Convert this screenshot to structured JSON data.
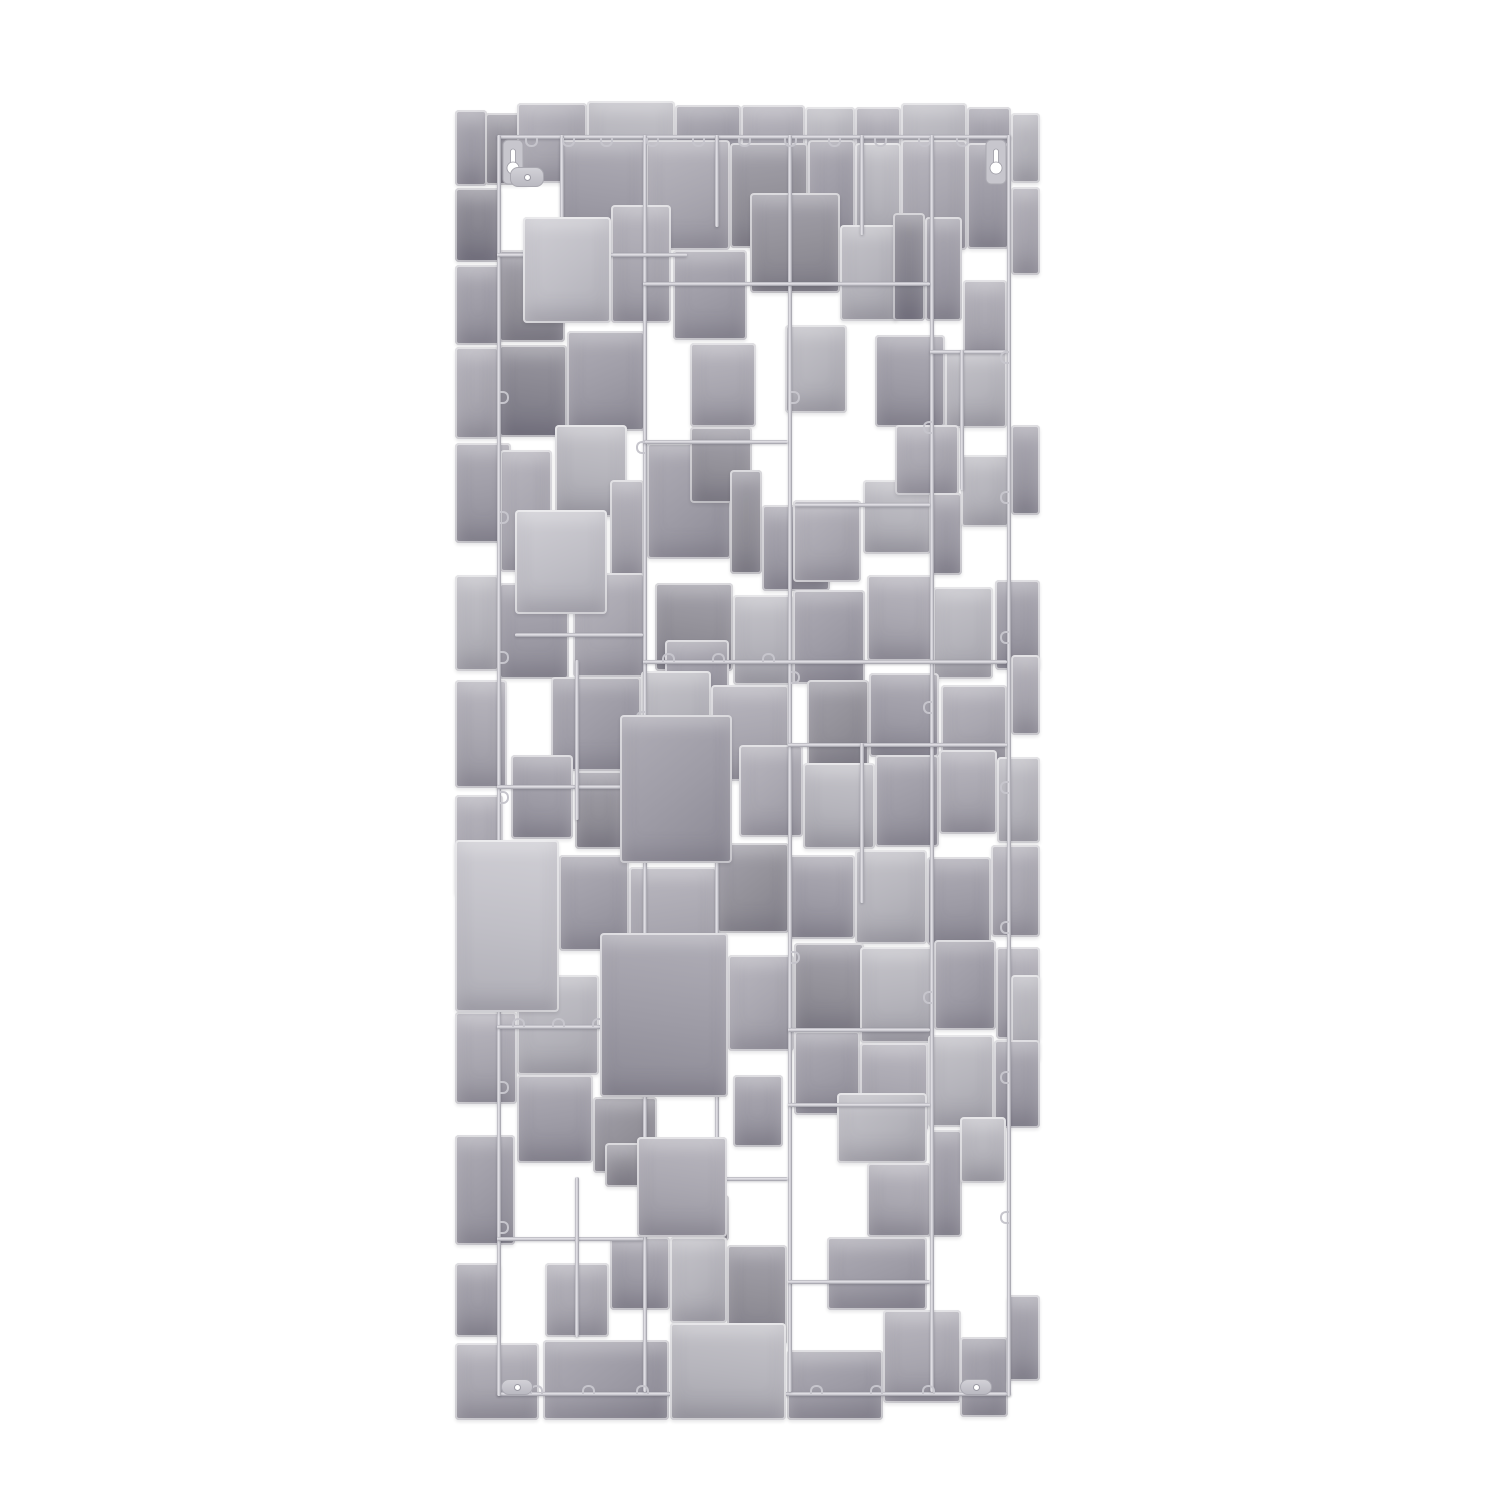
{
  "canvas": {
    "width": 1500,
    "height": 1500,
    "background": "#ffffff"
  },
  "artwork": {
    "name": "abstract-squares-metal-wall-sculpture",
    "x": 455,
    "y": 95,
    "width": 585,
    "height": 1325,
    "colors": {
      "wire_base": "#b4b3bb",
      "wire_light": "#e6e5ea",
      "wire_dark": "#9b9aa3",
      "clip": "#c6c5cc",
      "hanger_fill": "#c7c6cd",
      "hanger_stroke": "#a9a8b0",
      "hole": "#ffffff"
    },
    "palette": {
      "l1": [
        "#d0cfd5",
        "#c0bfc6",
        "#aeadb5"
      ],
      "l2": [
        "#c6c5cb",
        "#b6b5bc",
        "#a3a2aa"
      ],
      "m1": [
        "#bab8c0",
        "#a9a7b0",
        "#96949e"
      ],
      "m2": [
        "#b0aeb7",
        "#9e9ca6",
        "#8b8994"
      ],
      "d1": [
        "#a5a3ac",
        "#939199",
        "#817f89"
      ],
      "d2": [
        "#9a98a1",
        "#888690",
        "#767481"
      ]
    },
    "plates": [
      [
        0,
        15,
        32,
        76,
        "m2"
      ],
      [
        30,
        18,
        44,
        72,
        "d1"
      ],
      [
        62,
        8,
        70,
        80,
        "m1"
      ],
      [
        132,
        6,
        88,
        82,
        "l2"
      ],
      [
        220,
        10,
        66,
        72,
        "m2"
      ],
      [
        286,
        10,
        64,
        74,
        "m1"
      ],
      [
        350,
        12,
        50,
        70,
        "l2"
      ],
      [
        400,
        12,
        46,
        70,
        "m1"
      ],
      [
        446,
        8,
        66,
        78,
        "l2"
      ],
      [
        512,
        12,
        44,
        80,
        "m2"
      ],
      [
        556,
        18,
        29,
        70,
        "l2"
      ],
      [
        105,
        45,
        86,
        112,
        "m2"
      ],
      [
        191,
        45,
        84,
        110,
        "m1"
      ],
      [
        275,
        48,
        78,
        105,
        "d1"
      ],
      [
        353,
        45,
        47,
        102,
        "m2"
      ],
      [
        400,
        48,
        46,
        102,
        "l2"
      ],
      [
        446,
        45,
        66,
        110,
        "m1"
      ],
      [
        512,
        48,
        42,
        106,
        "m2"
      ],
      [
        556,
        92,
        29,
        88,
        "m1"
      ],
      [
        0,
        93,
        46,
        74,
        "d2"
      ],
      [
        0,
        170,
        46,
        80,
        "m2"
      ],
      [
        44,
        155,
        66,
        92,
        "d1"
      ],
      [
        68,
        122,
        88,
        106,
        "l1",
        1
      ],
      [
        156,
        110,
        60,
        118,
        "m1"
      ],
      [
        218,
        155,
        74,
        90,
        "m2"
      ],
      [
        295,
        98,
        90,
        100,
        "d1"
      ],
      [
        385,
        130,
        58,
        96,
        "l2"
      ],
      [
        438,
        118,
        32,
        108,
        "d2"
      ],
      [
        470,
        122,
        37,
        104,
        "m2"
      ],
      [
        508,
        185,
        44,
        80,
        "m1"
      ],
      [
        0,
        252,
        44,
        92,
        "m1"
      ],
      [
        44,
        250,
        68,
        92,
        "d2"
      ],
      [
        112,
        236,
        78,
        100,
        "m2"
      ],
      [
        235,
        248,
        66,
        84,
        "m1"
      ],
      [
        330,
        230,
        62,
        88,
        "l2"
      ],
      [
        420,
        240,
        70,
        92,
        "m2"
      ],
      [
        490,
        255,
        62,
        78,
        "l2"
      ],
      [
        0,
        348,
        56,
        100,
        "m2"
      ],
      [
        45,
        355,
        52,
        122,
        "m1"
      ],
      [
        100,
        330,
        72,
        92,
        "l2"
      ],
      [
        60,
        415,
        92,
        104,
        "l1",
        1
      ],
      [
        155,
        385,
        34,
        98,
        "m1"
      ],
      [
        192,
        348,
        84,
        116,
        "m2"
      ],
      [
        235,
        332,
        62,
        76,
        "d1"
      ],
      [
        275,
        375,
        32,
        104,
        "d1"
      ],
      [
        307,
        410,
        68,
        86,
        "m2"
      ],
      [
        338,
        405,
        68,
        82,
        "m1"
      ],
      [
        408,
        385,
        68,
        74,
        "l2"
      ],
      [
        440,
        330,
        64,
        70,
        "m1"
      ],
      [
        475,
        398,
        32,
        82,
        "m2"
      ],
      [
        506,
        360,
        48,
        72,
        "l2"
      ],
      [
        556,
        330,
        29,
        90,
        "m2"
      ],
      [
        0,
        480,
        44,
        96,
        "l2"
      ],
      [
        44,
        488,
        70,
        96,
        "m2"
      ],
      [
        118,
        478,
        72,
        104,
        "m1"
      ],
      [
        200,
        488,
        78,
        88,
        "d1"
      ],
      [
        210,
        545,
        64,
        68,
        "m2"
      ],
      [
        278,
        500,
        60,
        90,
        "l2"
      ],
      [
        338,
        495,
        72,
        94,
        "m2"
      ],
      [
        412,
        480,
        66,
        86,
        "m1"
      ],
      [
        478,
        492,
        60,
        92,
        "l2"
      ],
      [
        540,
        485,
        45,
        90,
        "m2"
      ],
      [
        96,
        582,
        90,
        94,
        "m2"
      ],
      [
        0,
        585,
        52,
        108,
        "m1"
      ],
      [
        186,
        576,
        70,
        80,
        "l2"
      ],
      [
        256,
        590,
        78,
        96,
        "m1"
      ],
      [
        352,
        585,
        62,
        88,
        "d1"
      ],
      [
        414,
        578,
        70,
        84,
        "m2"
      ],
      [
        486,
        590,
        66,
        80,
        "m1"
      ],
      [
        556,
        560,
        29,
        80,
        "m1"
      ],
      [
        165,
        620,
        112,
        148,
        "m2",
        1
      ],
      [
        56,
        660,
        62,
        84,
        "m2"
      ],
      [
        0,
        700,
        48,
        100,
        "m1"
      ],
      [
        120,
        676,
        48,
        78,
        "d1"
      ],
      [
        284,
        650,
        64,
        92,
        "m1"
      ],
      [
        348,
        668,
        72,
        86,
        "l2"
      ],
      [
        420,
        660,
        64,
        92,
        "m2"
      ],
      [
        484,
        655,
        58,
        84,
        "m1"
      ],
      [
        542,
        662,
        43,
        86,
        "l2"
      ],
      [
        0,
        745,
        104,
        172,
        "l1",
        1
      ],
      [
        104,
        760,
        70,
        96,
        "m2"
      ],
      [
        174,
        772,
        88,
        110,
        "m1"
      ],
      [
        262,
        748,
        72,
        90,
        "d1"
      ],
      [
        334,
        760,
        66,
        84,
        "m2"
      ],
      [
        400,
        755,
        72,
        94,
        "l2"
      ],
      [
        472,
        762,
        64,
        88,
        "m2"
      ],
      [
        536,
        750,
        49,
        92,
        "m1"
      ],
      [
        145,
        838,
        128,
        164,
        "m2",
        1
      ],
      [
        62,
        880,
        82,
        100,
        "l2"
      ],
      [
        0,
        917,
        62,
        92,
        "m1"
      ],
      [
        273,
        860,
        66,
        96,
        "m1"
      ],
      [
        339,
        848,
        70,
        88,
        "d1"
      ],
      [
        339,
        936,
        66,
        84,
        "m2"
      ],
      [
        405,
        852,
        74,
        96,
        "l2"
      ],
      [
        479,
        845,
        62,
        90,
        "m2"
      ],
      [
        541,
        852,
        44,
        92,
        "m1"
      ],
      [
        556,
        880,
        29,
        86,
        "l2"
      ],
      [
        62,
        980,
        76,
        88,
        "m2"
      ],
      [
        138,
        1002,
        64,
        76,
        "d1"
      ],
      [
        405,
        948,
        68,
        88,
        "m1"
      ],
      [
        473,
        940,
        66,
        92,
        "l2"
      ],
      [
        539,
        945,
        46,
        88,
        "m2"
      ],
      [
        0,
        1040,
        60,
        110,
        "m2"
      ],
      [
        182,
        1042,
        90,
        100,
        "m1",
        1
      ],
      [
        150,
        1048,
        38,
        44,
        "d1"
      ],
      [
        278,
        980,
        50,
        72,
        "m2"
      ],
      [
        382,
        998,
        90,
        70,
        "l2"
      ],
      [
        412,
        1068,
        64,
        74,
        "m1"
      ],
      [
        475,
        1035,
        32,
        107,
        "m2"
      ],
      [
        505,
        1022,
        46,
        66,
        "l2"
      ],
      [
        228,
        1100,
        46,
        46,
        "d1"
      ],
      [
        155,
        1142,
        60,
        73,
        "m2"
      ],
      [
        90,
        1168,
        64,
        74,
        "m1"
      ],
      [
        0,
        1168,
        46,
        74,
        "m2"
      ],
      [
        215,
        1142,
        57,
        86,
        "l2"
      ],
      [
        272,
        1150,
        60,
        100,
        "d1"
      ],
      [
        372,
        1142,
        100,
        73,
        "m2"
      ],
      [
        0,
        1248,
        84,
        77,
        "m1"
      ],
      [
        88,
        1245,
        126,
        80,
        "m2"
      ],
      [
        215,
        1228,
        116,
        97,
        "l2",
        1
      ],
      [
        332,
        1255,
        96,
        70,
        "m2"
      ],
      [
        428,
        1215,
        78,
        93,
        "m1"
      ],
      [
        505,
        1242,
        48,
        80,
        "m2"
      ],
      [
        552,
        1200,
        33,
        86,
        "m2"
      ]
    ],
    "rods": [
      {
        "o": "h",
        "x": 42,
        "y": 40,
        "len": 514
      },
      {
        "o": "h",
        "x": 42,
        "y": 1297,
        "len": 514
      },
      {
        "o": "v",
        "x": 42,
        "y": 40,
        "len": 1261
      },
      {
        "o": "v",
        "x": 552,
        "y": 40,
        "len": 1261
      },
      {
        "o": "v",
        "x": 188,
        "y": 40,
        "len": 1257
      },
      {
        "o": "v",
        "x": 333,
        "y": 40,
        "len": 1257
      },
      {
        "o": "v",
        "x": 475,
        "y": 40,
        "len": 1257
      },
      {
        "o": "h",
        "x": 42,
        "y": 158,
        "len": 190
      },
      {
        "o": "h",
        "x": 188,
        "y": 187,
        "len": 287
      },
      {
        "o": "h",
        "x": 475,
        "y": 255,
        "len": 77
      },
      {
        "o": "h",
        "x": 188,
        "y": 345,
        "len": 145
      },
      {
        "o": "h",
        "x": 340,
        "y": 408,
        "len": 135
      },
      {
        "o": "h",
        "x": 60,
        "y": 538,
        "len": 128
      },
      {
        "o": "h",
        "x": 188,
        "y": 565,
        "len": 364
      },
      {
        "o": "h",
        "x": 333,
        "y": 648,
        "len": 219
      },
      {
        "o": "h",
        "x": 42,
        "y": 690,
        "len": 146
      },
      {
        "o": "h",
        "x": 42,
        "y": 930,
        "len": 146
      },
      {
        "o": "h",
        "x": 333,
        "y": 933,
        "len": 142
      },
      {
        "o": "h",
        "x": 333,
        "y": 1008,
        "len": 142
      },
      {
        "o": "h",
        "x": 188,
        "y": 1082,
        "len": 145
      },
      {
        "o": "h",
        "x": 42,
        "y": 1142,
        "len": 146
      },
      {
        "o": "h",
        "x": 333,
        "y": 1185,
        "len": 142
      },
      {
        "o": "v",
        "x": 105,
        "y": 40,
        "len": 120
      },
      {
        "o": "v",
        "x": 260,
        "y": 40,
        "len": 92
      },
      {
        "o": "v",
        "x": 405,
        "y": 40,
        "len": 100
      },
      {
        "o": "v",
        "x": 120,
        "y": 565,
        "len": 160
      },
      {
        "o": "v",
        "x": 260,
        "y": 700,
        "len": 150
      },
      {
        "o": "v",
        "x": 405,
        "y": 648,
        "len": 160
      },
      {
        "o": "v",
        "x": 120,
        "y": 1082,
        "len": 160
      },
      {
        "o": "v",
        "x": 260,
        "y": 933,
        "len": 150
      },
      {
        "o": "v",
        "x": 505,
        "y": 255,
        "len": 140
      }
    ],
    "clips": [
      [
        70,
        43,
        "t"
      ],
      [
        107,
        43,
        "t"
      ],
      [
        145,
        43,
        "t"
      ],
      [
        191,
        43,
        "t"
      ],
      [
        237,
        43,
        "t"
      ],
      [
        283,
        43,
        "t"
      ],
      [
        329,
        43,
        "t"
      ],
      [
        373,
        43,
        "t"
      ],
      [
        419,
        43,
        "t"
      ],
      [
        463,
        43,
        "t"
      ],
      [
        501,
        43,
        "t"
      ],
      [
        75,
        1290,
        "b"
      ],
      [
        127,
        1290,
        "b"
      ],
      [
        181,
        1290,
        "b"
      ],
      [
        237,
        1290,
        "b"
      ],
      [
        295,
        1290,
        "b"
      ],
      [
        355,
        1290,
        "b"
      ],
      [
        415,
        1290,
        "b"
      ],
      [
        467,
        1290,
        "b"
      ],
      [
        510,
        1290,
        "b"
      ],
      [
        207,
        558,
        "b"
      ],
      [
        257,
        558,
        "b"
      ],
      [
        307,
        558,
        "b"
      ],
      [
        57,
        923,
        "b"
      ],
      [
        97,
        923,
        "b"
      ],
      [
        137,
        923,
        "b"
      ],
      [
        207,
        1075,
        "b"
      ],
      [
        251,
        1075,
        "b"
      ],
      [
        45,
        296,
        "l"
      ],
      [
        45,
        416,
        "l"
      ],
      [
        45,
        556,
        "l"
      ],
      [
        45,
        696,
        "l"
      ],
      [
        45,
        836,
        "l"
      ],
      [
        45,
        986,
        "l"
      ],
      [
        45,
        1126,
        "l"
      ],
      [
        545,
        256,
        "r"
      ],
      [
        545,
        396,
        "r"
      ],
      [
        545,
        536,
        "r"
      ],
      [
        545,
        686,
        "r"
      ],
      [
        545,
        826,
        "r"
      ],
      [
        545,
        976,
        "r"
      ],
      [
        545,
        1116,
        "r"
      ],
      [
        181,
        346,
        "r"
      ],
      [
        181,
        616,
        "r"
      ],
      [
        181,
        886,
        "r"
      ],
      [
        336,
        296,
        "l"
      ],
      [
        336,
        576,
        "l"
      ],
      [
        336,
        856,
        "l"
      ],
      [
        468,
        326,
        "r"
      ],
      [
        468,
        606,
        "r"
      ],
      [
        468,
        896,
        "r"
      ]
    ],
    "hangers": [
      {
        "x": 47,
        "y": 44
      },
      {
        "x": 530,
        "y": 44
      }
    ],
    "tabs": [
      {
        "x": 55,
        "y": 72,
        "w": 34,
        "h": 20
      },
      {
        "x": 46,
        "y": 1284,
        "w": 32,
        "h": 16
      },
      {
        "x": 505,
        "y": 1284,
        "w": 32,
        "h": 16
      }
    ]
  }
}
